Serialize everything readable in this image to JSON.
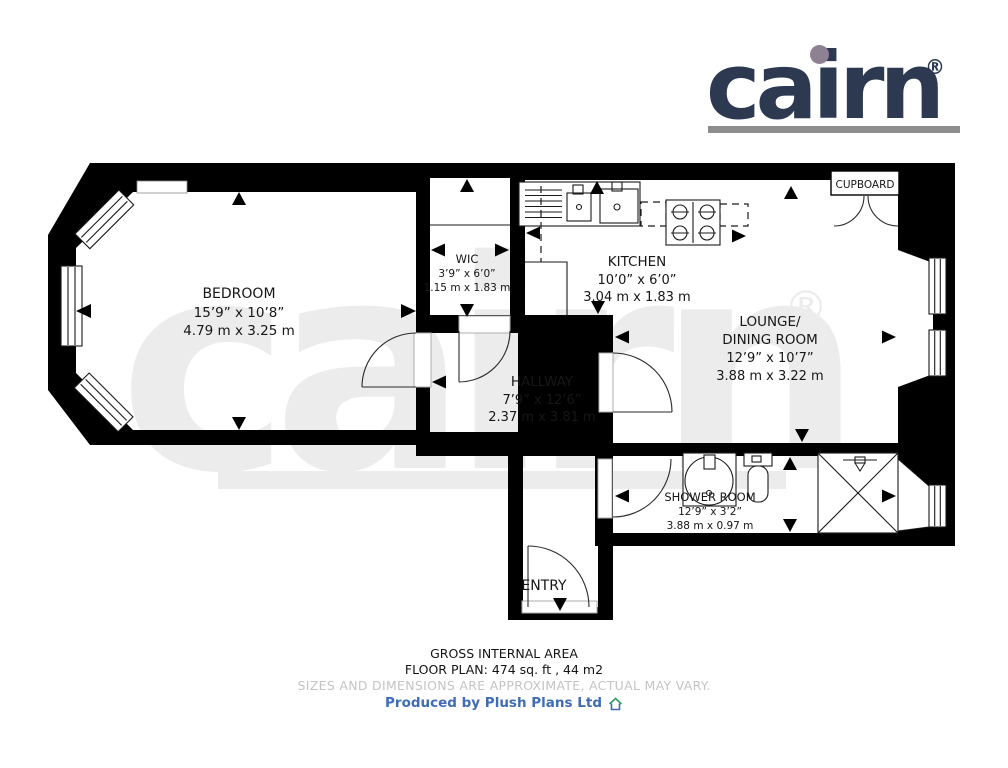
{
  "brand": {
    "logo_text": "cairn",
    "registered": "®"
  },
  "watermark": {
    "text": "cairn",
    "registered": "®"
  },
  "rooms": {
    "bedroom": {
      "name": "BEDROOM",
      "imperial": "15’9” x 10’8”",
      "metric": "4.79 m x 3.25 m"
    },
    "wic": {
      "name": "WIC",
      "imperial": "3’9” x 6’0”",
      "metric": "1.15 m x 1.83 m"
    },
    "kitchen": {
      "name": "KITCHEN",
      "imperial": "10’0” x 6’0”",
      "metric": "3.04 m x 1.83 m"
    },
    "lounge": {
      "name_line1": "LOUNGE/",
      "name_line2": "DINING ROOM",
      "imperial": "12’9” x 10’7”",
      "metric": "3.88 m x 3.22 m"
    },
    "hallway": {
      "name": "HALLWAY",
      "imperial": "7’9” x 12’6”",
      "metric": "2.37 m x 3.81 m"
    },
    "shower_room": {
      "name": "SHOWER ROOM",
      "imperial": "12’9” x 3’2”",
      "metric": "3.88 m x 0.97 m"
    },
    "entry": {
      "name": "ENTRY"
    },
    "cupboard": {
      "name": "CUPBOARD"
    }
  },
  "footer": {
    "area_title": "GROSS INTERNAL AREA",
    "area_value": "FLOOR PLAN: 474 sq. ft , 44 m2",
    "disclaimer": "SIZES AND DIMENSIONS ARE APPROXIMATE, ACTUAL MAY VARY.",
    "credit": "Produced by Plush Plans Ltd"
  },
  "colors": {
    "logo_navy": "#2c3951",
    "logo_dot": "#8e8191",
    "logo_bar": "#8d8d8d",
    "watermark_gray": "#ececec",
    "wall_black": "#000000",
    "disclaimer_gray": "#c4c4c4",
    "credit_blue": "#3f6cb5",
    "house_icon_green": "#2f9e63"
  }
}
